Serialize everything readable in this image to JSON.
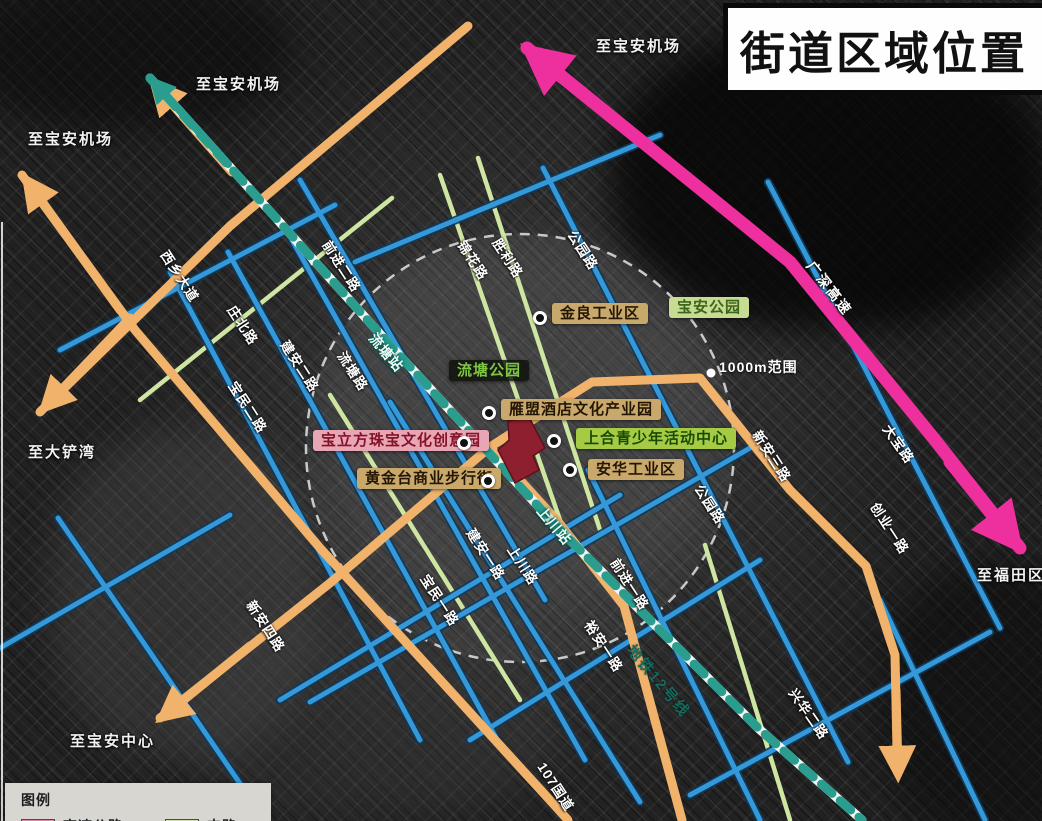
{
  "title": "街道区域位置",
  "legend": {
    "title": "图例",
    "items": [
      {
        "label": "高速公路"
      },
      {
        "label": "支路"
      }
    ]
  },
  "highway": {
    "name": "广深高速",
    "label": {
      "x": 816,
      "y": 258,
      "rot": 52
    }
  },
  "metro": {
    "line_label": {
      "text": "地铁12号线",
      "x": 636,
      "y": 642,
      "rot": 50
    },
    "stations": [
      {
        "text": "流塘站",
        "x": 378,
        "y": 330,
        "rot": 50
      },
      {
        "text": "上川站",
        "x": 546,
        "y": 503,
        "rot": 50
      }
    ]
  },
  "range": {
    "text": "1000m范围",
    "x": 719,
    "y": 359
  },
  "direction_labels": [
    {
      "text": "至宝安机场",
      "x": 196,
      "y": 76
    },
    {
      "text": "至宝安机场",
      "x": 28,
      "y": 131
    },
    {
      "text": "至宝安机场",
      "x": 596,
      "y": 38
    },
    {
      "text": "至大铲湾",
      "x": 28,
      "y": 444
    },
    {
      "text": "至宝安中心",
      "x": 70,
      "y": 733
    },
    {
      "text": "至福田区",
      "x": 977,
      "y": 567
    }
  ],
  "road_labels": [
    {
      "text": "西乡大道",
      "x": 170,
      "y": 248,
      "rot": 57
    },
    {
      "text": "前进二路",
      "x": 332,
      "y": 238,
      "rot": 57
    },
    {
      "text": "庄北路",
      "x": 237,
      "y": 303,
      "rot": 57
    },
    {
      "text": "建安二路",
      "x": 290,
      "y": 338,
      "rot": 57
    },
    {
      "text": "流塘路",
      "x": 347,
      "y": 349,
      "rot": 57
    },
    {
      "text": "宝民二路",
      "x": 238,
      "y": 379,
      "rot": 57
    },
    {
      "text": "锦花路",
      "x": 467,
      "y": 238,
      "rot": 57
    },
    {
      "text": "胜利路",
      "x": 502,
      "y": 236,
      "rot": 57
    },
    {
      "text": "公园路",
      "x": 577,
      "y": 228,
      "rot": 57
    },
    {
      "text": "新安三路",
      "x": 762,
      "y": 428,
      "rot": 57
    },
    {
      "text": "大宝路",
      "x": 892,
      "y": 422,
      "rot": 55
    },
    {
      "text": "公园路",
      "x": 704,
      "y": 482,
      "rot": 57
    },
    {
      "text": "创业一路",
      "x": 880,
      "y": 500,
      "rot": 57
    },
    {
      "text": "前进一路",
      "x": 620,
      "y": 556,
      "rot": 57
    },
    {
      "text": "建安一路",
      "x": 476,
      "y": 526,
      "rot": 57
    },
    {
      "text": "上川路",
      "x": 517,
      "y": 543,
      "rot": 57
    },
    {
      "text": "宝民一路",
      "x": 430,
      "y": 572,
      "rot": 57
    },
    {
      "text": "新安四路",
      "x": 256,
      "y": 598,
      "rot": 57
    },
    {
      "text": "裕安一路",
      "x": 594,
      "y": 618,
      "rot": 57
    },
    {
      "text": "兴华二路",
      "x": 798,
      "y": 686,
      "rot": 55
    },
    {
      "text": "107国道",
      "x": 547,
      "y": 760,
      "rot": 57
    }
  ],
  "pois": [
    {
      "text": "金良工业区",
      "style": "tan",
      "x": 552,
      "y": 303,
      "dot_x": 540,
      "dot_y": 318
    },
    {
      "text": "宝安公园",
      "style": "park-light",
      "x": 669,
      "y": 297
    },
    {
      "text": "流塘公园",
      "style": "park-dark",
      "x": 449,
      "y": 360
    },
    {
      "text": "雁盟酒店文化产业园",
      "style": "tan",
      "x": 501,
      "y": 399,
      "dot_x": 489,
      "dot_y": 413
    },
    {
      "text": "宝立方珠宝文化创意园",
      "style": "pink",
      "x": 313,
      "y": 430,
      "dot_x": 464,
      "dot_y": 443
    },
    {
      "text": "上合青少年活动中心",
      "style": "green",
      "x": 576,
      "y": 428,
      "dot_x": 554,
      "dot_y": 441
    },
    {
      "text": "黄金台商业步行街",
      "style": "tan",
      "x": 357,
      "y": 468,
      "dot_x": 488,
      "dot_y": 481
    },
    {
      "text": "安华工业区",
      "style": "tan",
      "x": 588,
      "y": 459,
      "dot_x": 570,
      "dot_y": 470
    }
  ],
  "colors": {
    "highway_pink": "#ee2f9e",
    "arterial_orange": "#f1b26b",
    "secondary_blue": "#3598d8",
    "branch_green": "#cfe6a2",
    "metro_teal": "#2a9d8f",
    "boundary_red": "#8e1f2f"
  }
}
